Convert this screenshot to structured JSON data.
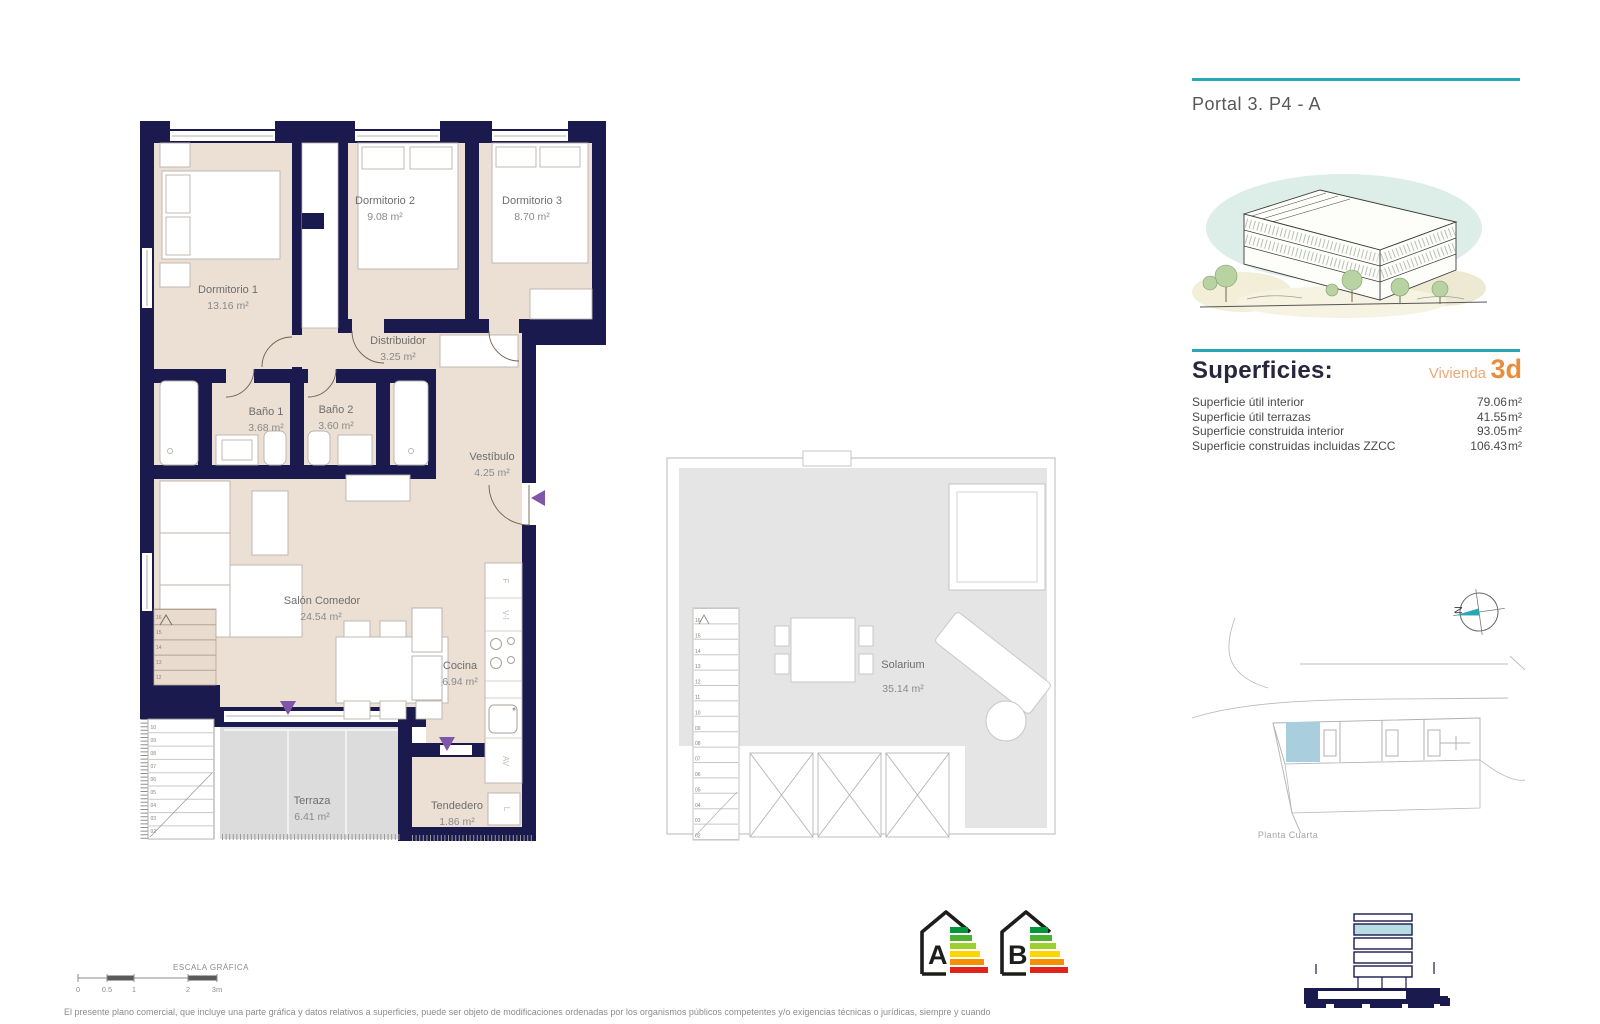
{
  "header": {
    "title": "Portal 3. P4 - A"
  },
  "superficies": {
    "heading": "Superficies:",
    "vivienda_label": "Vivienda",
    "vivienda_code": "3d",
    "rows": [
      {
        "label": "Superficie útil interior",
        "value": "79.06",
        "unit": "m²"
      },
      {
        "label": "Superficie útil terrazas",
        "value": "41.55",
        "unit": "m²"
      },
      {
        "label": "Superficie construida interior",
        "value": "93.05",
        "unit": "m²"
      },
      {
        "label": "Superficie construidas incluidas ZZCC",
        "value": "106.43",
        "unit": "m²"
      }
    ]
  },
  "floorplan": {
    "rooms": {
      "dormitorio1": {
        "name": "Dormitorio 1",
        "area": "13.16 m²"
      },
      "dormitorio2": {
        "name": "Dormitorio 2",
        "area": "9.08 m²"
      },
      "dormitorio3": {
        "name": "Dormitorio 3",
        "area": "8.70 m²"
      },
      "distribuidor": {
        "name": "Distribuidor",
        "area": "3.25 m²"
      },
      "bano1": {
        "name": "Baño 1",
        "area": "3.68 m²"
      },
      "bano2": {
        "name": "Baño 2",
        "area": "3.60 m²"
      },
      "vestibulo": {
        "name": "Vestíbulo",
        "area": "4.25 m²"
      },
      "salon": {
        "name": "Salón Comedor",
        "area": "24.54 m²"
      },
      "cocina": {
        "name": "Cocina",
        "area": "6.94 m²"
      },
      "terraza": {
        "name": "Terraza",
        "area": "6.41 m²"
      },
      "tendedero": {
        "name": "Tendedero",
        "area": "1.86 m²"
      }
    },
    "kitchen_appliance_labels": {
      "fridge": "F",
      "oven_column": "V-I",
      "dishwasher": "AV",
      "washer": "L"
    },
    "stair_numbers_upper": [
      "16",
      "15",
      "14",
      "13",
      "12"
    ],
    "stair_numbers_lower": [
      "10",
      "09",
      "08",
      "07",
      "06",
      "05",
      "04",
      "03",
      "02"
    ]
  },
  "solarium_plan": {
    "room": {
      "name": "Solarium",
      "area": "35.14 m²"
    },
    "stair_numbers": [
      "16",
      "15",
      "14",
      "13",
      "12",
      "11",
      "10",
      "09",
      "08",
      "07",
      "06",
      "05",
      "04",
      "03",
      "02"
    ]
  },
  "site_plan": {
    "caption": "Planta Cuarta",
    "north_label": "N"
  },
  "scale_bar": {
    "title": "ESCALA GRÁFICA",
    "ticks": [
      "0",
      "0.5",
      "1",
      "2",
      "3m"
    ]
  },
  "energy_badges": [
    "A",
    "B"
  ],
  "colors": {
    "wall_navy": "#1a1a4e",
    "floor_beige": "#ecdfd4",
    "terrace_gray": "#dcdcdc",
    "accent_teal": "#2ba7b4",
    "accent_orange": "#e98c3c",
    "accent_orange_light": "#efa878",
    "unit_highlight_blue": "#a9cedd",
    "entry_arrow_purple": "#8056a8",
    "energy_scale": [
      "#00963b",
      "#4caf32",
      "#9ccf2f",
      "#ffd500",
      "#f59100",
      "#e2231a"
    ]
  },
  "page": {
    "disclaimer": "El presente plano comercial, que incluye una parte gráfica y datos relativos a superficies, puede ser objeto de modificaciones ordenadas por los organismos públicos competentes y/o exigencias técnicas o jurídicas, siempre y cuando"
  }
}
